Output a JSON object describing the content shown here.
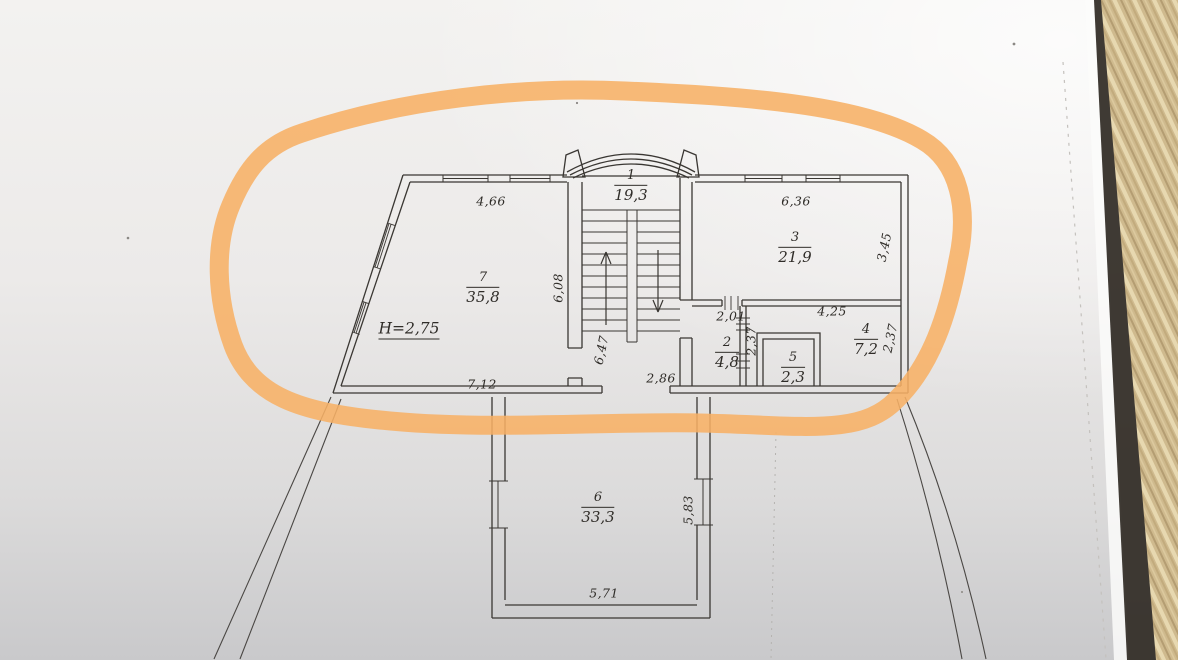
{
  "plan": {
    "height_note": "H=2,75",
    "rooms": [
      {
        "id": "1",
        "area": "19,3"
      },
      {
        "id": "2",
        "area": "4,8"
      },
      {
        "id": "3",
        "area": "21,9"
      },
      {
        "id": "4",
        "area": "7,2"
      },
      {
        "id": "5",
        "area": "2,3"
      },
      {
        "id": "6",
        "area": "33,3"
      },
      {
        "id": "7",
        "area": "35,8"
      }
    ],
    "dims": {
      "room7_top": "4,66",
      "room7_bottom": "7,12",
      "room7_right": "6,08",
      "room3_top": "6,36",
      "room3_right": "3,45",
      "room2_top": "2,01",
      "room2_right": "2,37",
      "room4_top": "4,25",
      "room4_right": "2,37",
      "stair_hall": "6,47",
      "corridor_opening": "2,86",
      "room6_right": "5,83",
      "room6_bottom": "5,71"
    },
    "colors": {
      "highlight_marker": "#F7B065",
      "plan_line": "#3A3733",
      "paper": "#ECEAE9",
      "wood_table": "#CDB88C"
    }
  }
}
